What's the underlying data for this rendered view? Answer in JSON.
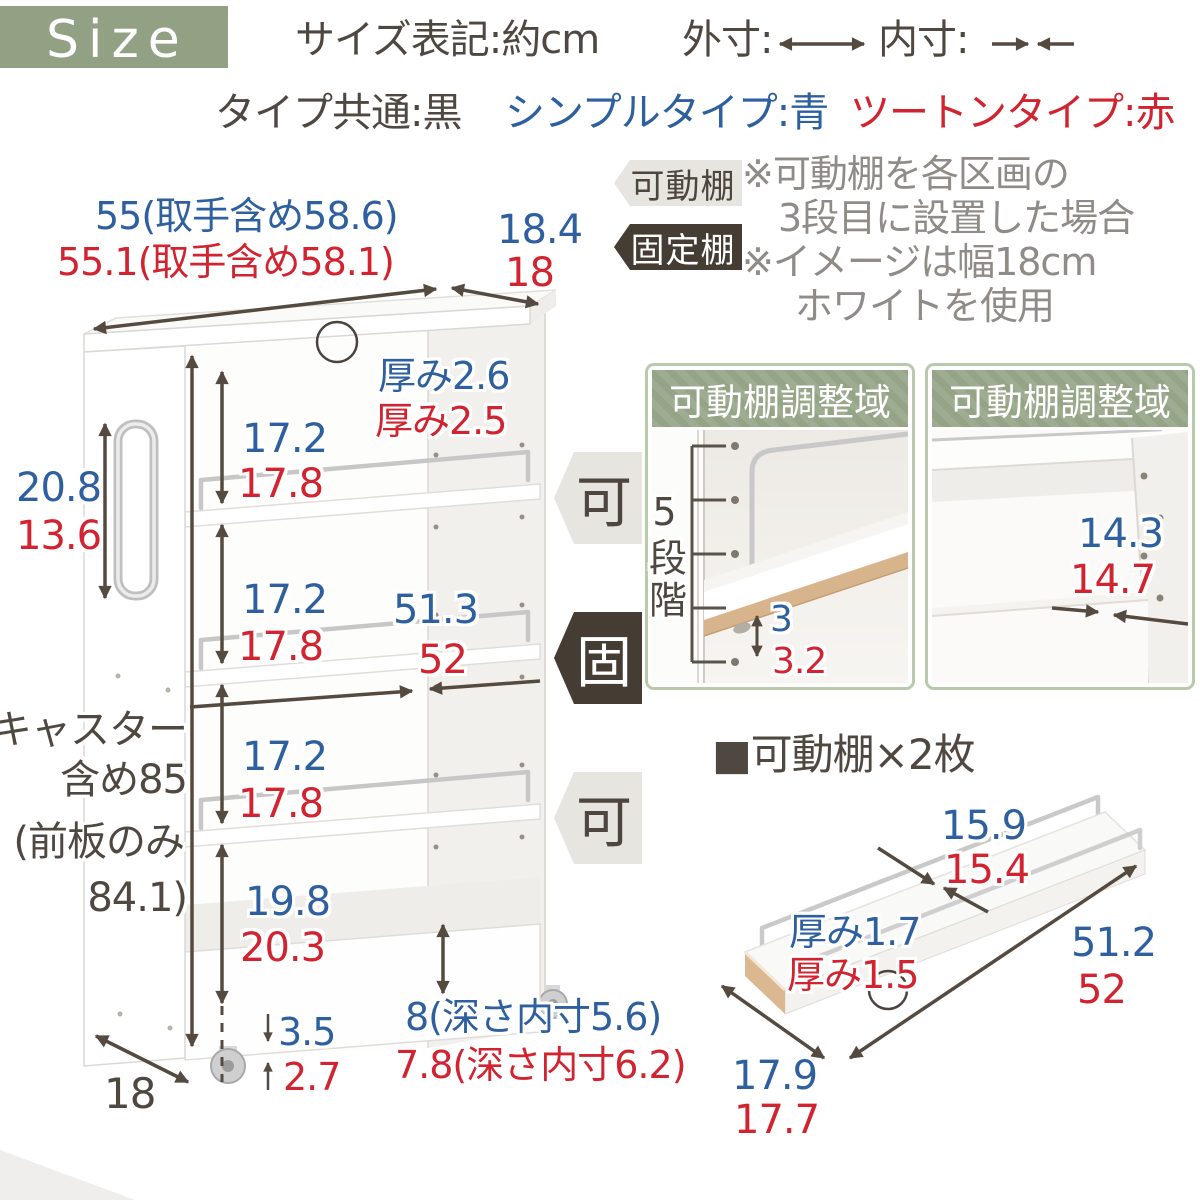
{
  "header": {
    "size_label": "Size",
    "notation": "サイズ表記:約cm",
    "outer_label": "外寸:",
    "inner_label": "内寸:",
    "type_common": "タイプ共通:黒",
    "type_simple": "シンプルタイプ:青",
    "type_twotone": "ツートンタイプ:赤"
  },
  "legend_tags": {
    "movable": "可動棚",
    "fixed": "固定棚"
  },
  "notes": {
    "line1": "※可動棚を各区画の",
    "line2": "3段目に設置した場合",
    "line3": "※イメージは幅18cm",
    "line4": "ホワイトを使用"
  },
  "main_diagram": {
    "width_outer": "55(取手含め58.6)",
    "width_inner": "55.1(取手含め58.1)",
    "top_depth_outer": "18.4",
    "top_depth_inner": "18",
    "top_thickness_outer": "厚み2.6",
    "top_thickness_inner": "厚み2.5",
    "section1_outer": "17.2",
    "section1_inner": "17.8",
    "handle_outer": "20.8",
    "handle_inner": "13.6",
    "section2_outer": "17.2",
    "section2_inner": "17.8",
    "inner_width_outer": "51.3",
    "inner_width_inner": "52",
    "section3_outer": "17.2",
    "section3_inner": "17.8",
    "height_line1": "キャスター",
    "height_line2": "含め85",
    "height_line3": "(前板のみ",
    "height_line4": "84.1)",
    "section4_outer": "19.8",
    "section4_inner": "20.3",
    "caster_outer": "3.5",
    "caster_inner": "2.7",
    "base_depth": "18",
    "bin_depth_outer": "8(深さ内寸5.6)",
    "bin_depth_inner": "7.8(深さ内寸6.2)",
    "tag_movable": "可",
    "tag_fixed": "固"
  },
  "adjust_boxes": {
    "title": "可動棚調整域",
    "left": {
      "steps": "5段階",
      "pitch_outer": "3",
      "pitch_inner": "3.2"
    },
    "right": {
      "clearance_outer": "14.3",
      "clearance_inner": "14.7"
    }
  },
  "shelf_detail": {
    "title": "■可動棚×2枚",
    "depth_outer": "15.9",
    "depth_inner": "15.4",
    "thickness_outer": "厚み1.7",
    "thickness_inner": "厚み1.5",
    "length_outer": "51.2",
    "length_inner": "52",
    "width_outer": "17.9",
    "width_inner": "17.7"
  },
  "colors": {
    "outer_blue": "#2e5f9e",
    "inner_red": "#d12430",
    "accent_green": "#92a183",
    "line_dark": "#554a40"
  }
}
